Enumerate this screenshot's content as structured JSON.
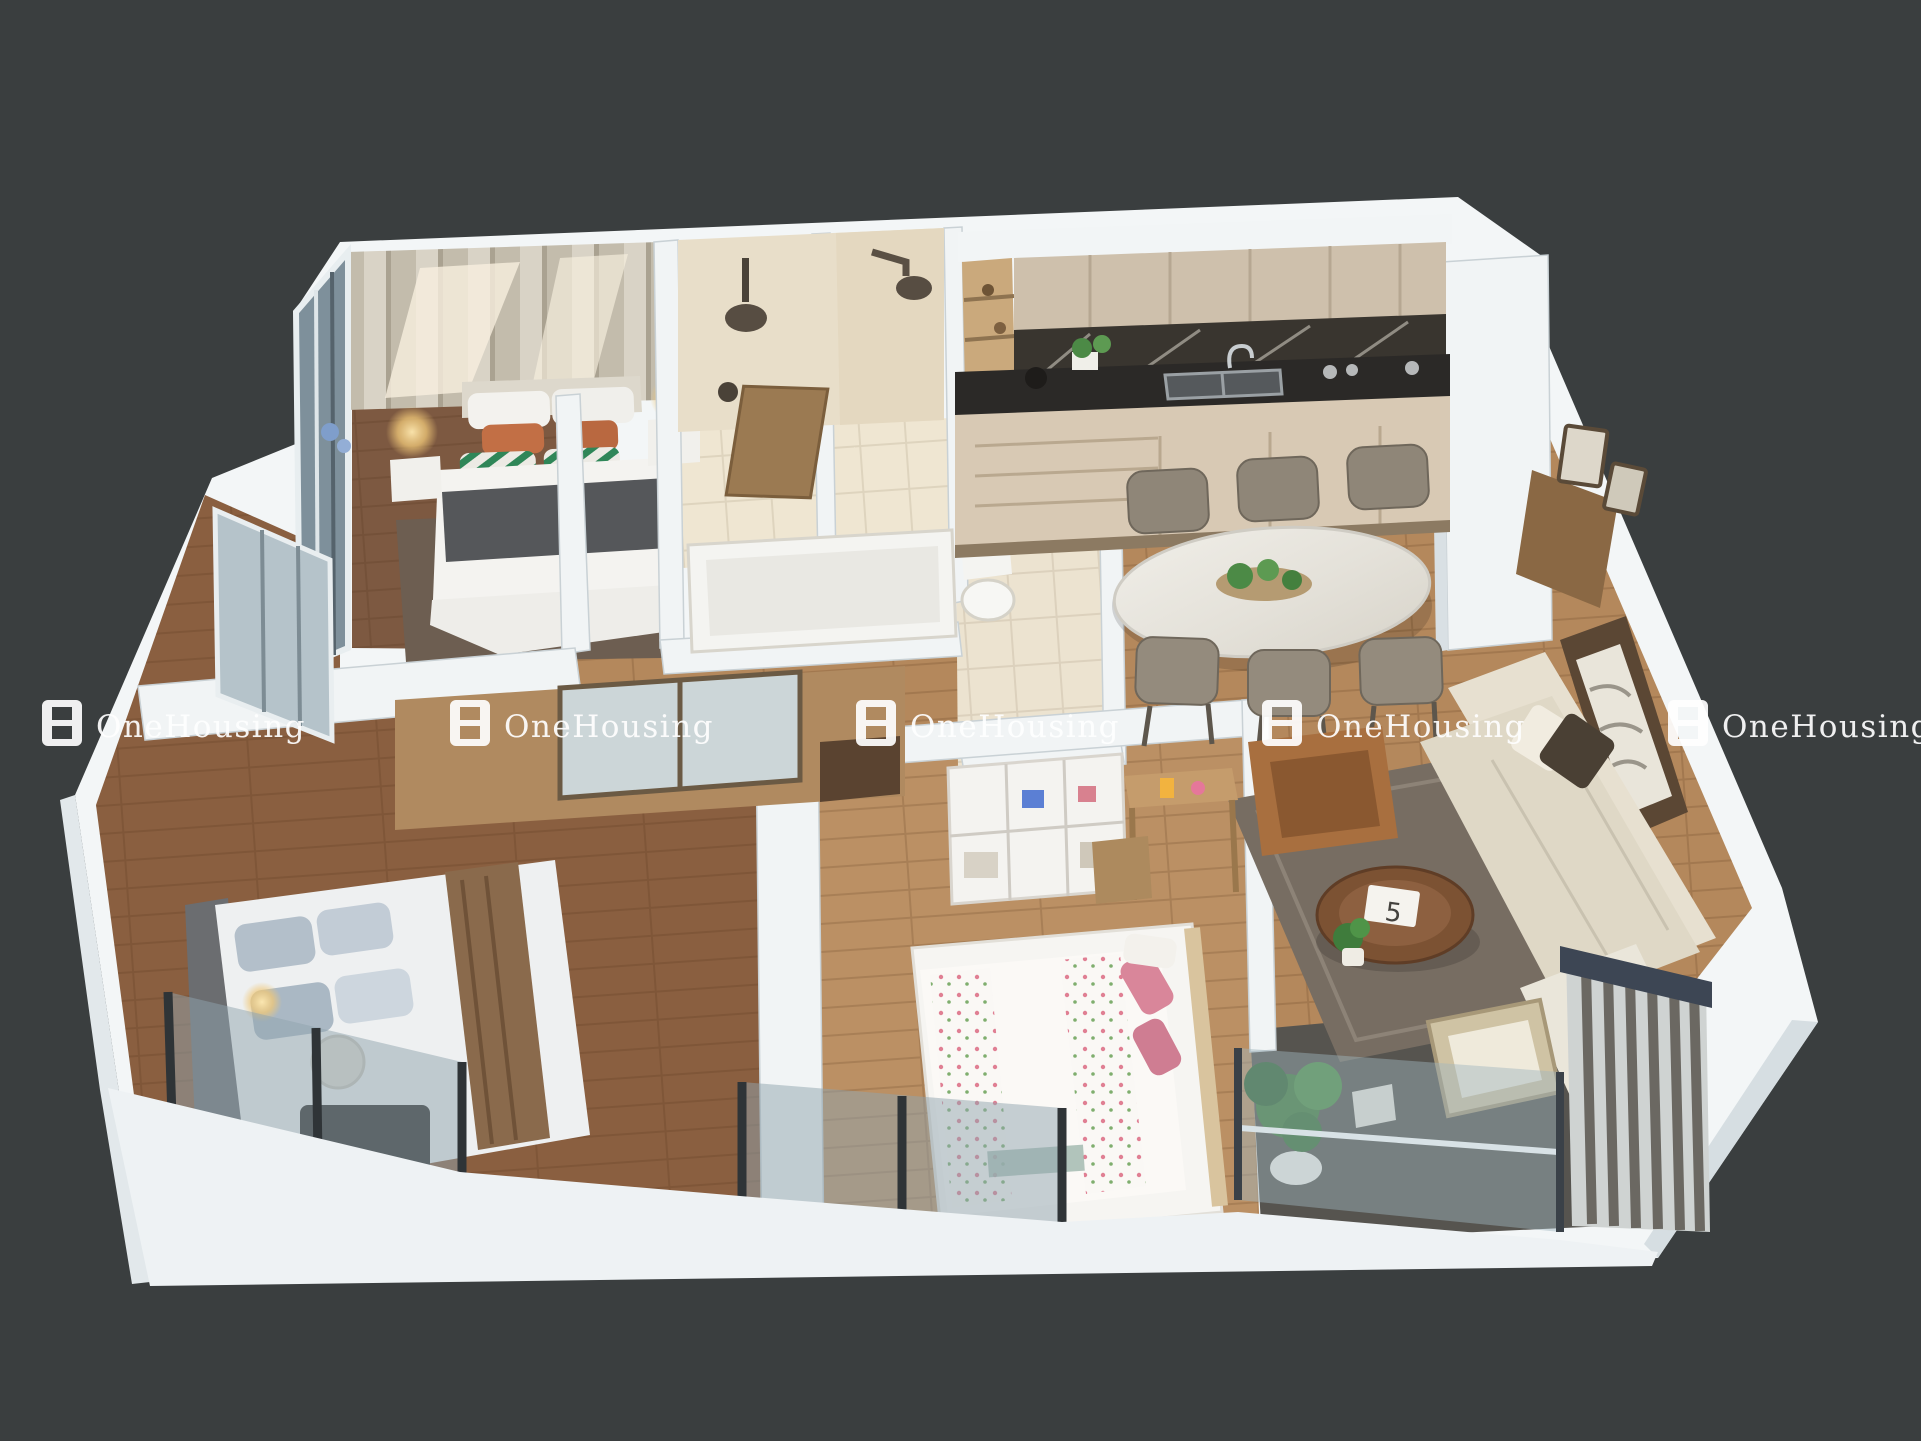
{
  "scene": {
    "description": "Photorealistic 3D cutaway floor plan render of a 3-bedroom apartment on a dark charcoal background",
    "background_color": "#3a3e3f"
  },
  "watermark": {
    "text": "OneHousing",
    "count": 5,
    "color": "#ffffff",
    "logo": "two-pane-window-icon"
  },
  "living_room": {
    "coffee_table_card": "5"
  },
  "palette": {
    "wall_white": "#f3f6f7",
    "wood_floor": "#b4885c",
    "wood_floor_dark": "#8a5f40",
    "wood_floor_light": "#bb9064",
    "bathroom_tile": "#e8dec9",
    "kitchen_counter_marble": "#2b2927",
    "kitchen_cabinet": "#cec0ac",
    "balcony_floor": "#56544f",
    "sofa_cream": "#e7e0d0",
    "armchair_leather": "#a86f3f",
    "pillow_orange": "#c26f45",
    "pillow_green": "#2f8658",
    "pillow_pink": "#d9869a",
    "plant_green": "#3e7b39",
    "glass_blue": "#8fa3ad",
    "railing_navy": "#3d4654"
  }
}
